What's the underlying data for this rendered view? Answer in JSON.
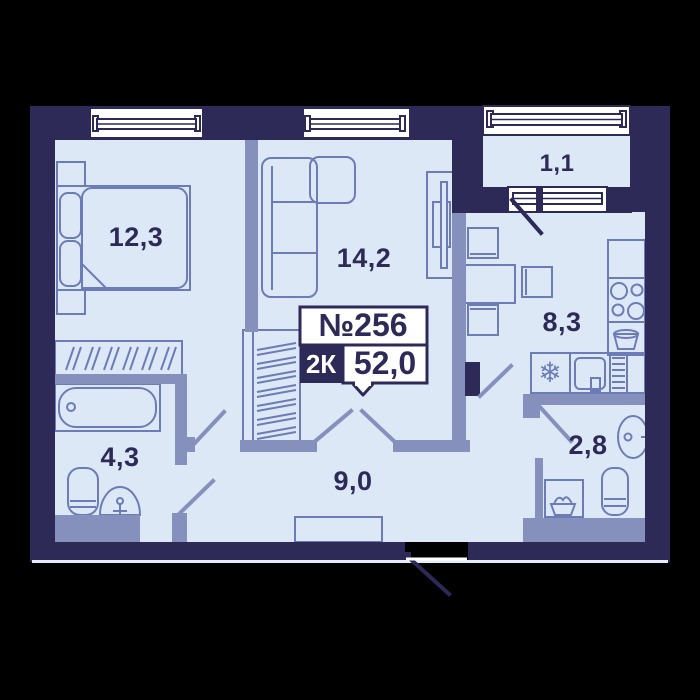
{
  "plan": {
    "badge": {
      "number": "№256",
      "type": "2К",
      "area": "52,0"
    },
    "rooms": [
      {
        "name": "bedroom",
        "area": "12,3"
      },
      {
        "name": "living-room",
        "area": "14,2"
      },
      {
        "name": "balcony",
        "area": "1,1"
      },
      {
        "name": "kitchen",
        "area": "8,3"
      },
      {
        "name": "bathroom",
        "area": "4,3"
      },
      {
        "name": "toilet-room",
        "area": "2,8"
      },
      {
        "name": "hallway",
        "area": "9,0"
      }
    ],
    "icons": {
      "fridge_snowflake": "❄"
    },
    "colors": {
      "background": "#000000",
      "wall_outer": "#2d2a58",
      "wall_inner": "#8690bd",
      "floor": "#dce8f6",
      "furniture_line": "#6d7cb7",
      "window": "#ffffff",
      "label_text": "#2d2a58"
    }
  }
}
